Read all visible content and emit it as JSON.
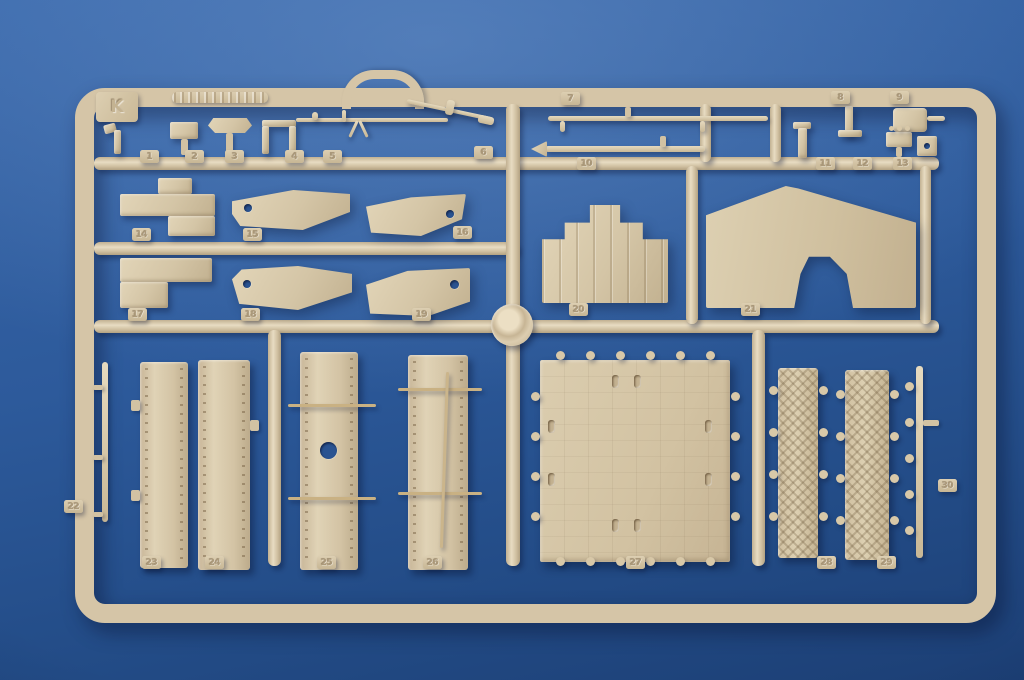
{
  "scene": {
    "subject": "Tan plastic injection-molded model kit sprue photographed on a blue background",
    "background_color": "#2c5898",
    "plastic_color": "#d6c7ab"
  },
  "sprue": {
    "letter": "K",
    "part_tags": [
      "1",
      "2",
      "3",
      "4",
      "5",
      "6",
      "7",
      "8",
      "9",
      "10",
      "11",
      "12",
      "13",
      "14",
      "15",
      "16",
      "17",
      "18",
      "19",
      "20",
      "21",
      "22",
      "23",
      "24",
      "25",
      "26",
      "27",
      "28",
      "29",
      "30"
    ]
  }
}
